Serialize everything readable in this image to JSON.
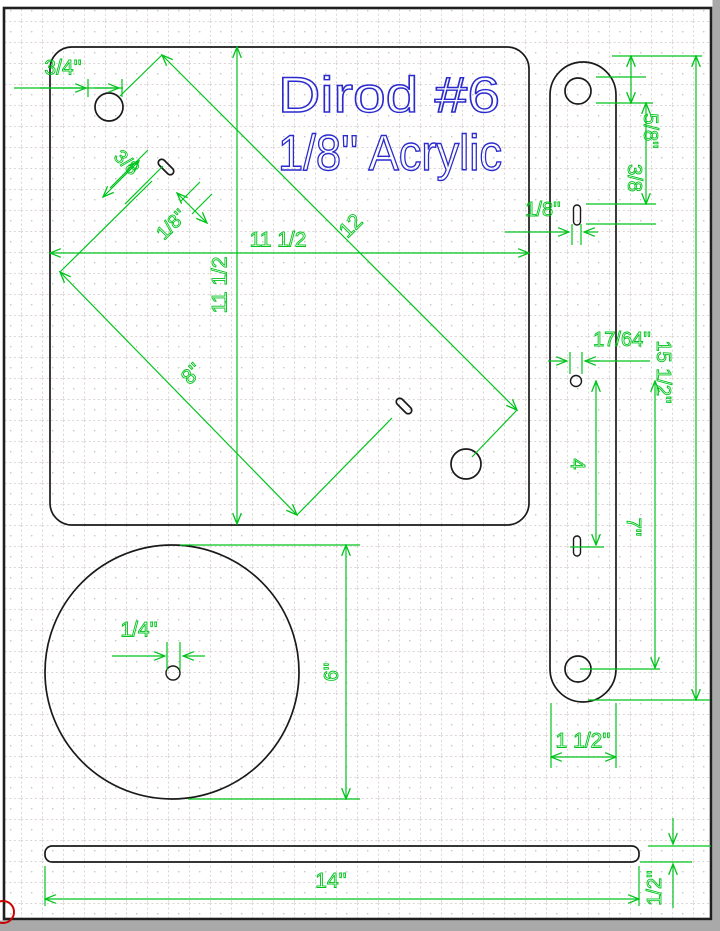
{
  "title": {
    "line1": "Dirod #6",
    "line2": "1/8'' Acrylic"
  },
  "plate": {
    "hole_offset": "3/4''",
    "width": "11 1/2",
    "height": "11 1/2",
    "hole_diagonal": "12",
    "slot_diagonal": "8''",
    "slot_length": "3/8",
    "slot_width": "1/8''"
  },
  "side_bar": {
    "end_hole_offset": "5/8''",
    "hole_to_slot": "3/8",
    "slot_width": "1/8''",
    "center_hole_dia": "17/64''",
    "length": "15 1/2''",
    "hole_to_lower_slot": "4",
    "hole_spacing": "7''",
    "width": "1 1/2''"
  },
  "disc": {
    "center_hole_dia": "1/4''",
    "diameter": "6''"
  },
  "base_strip": {
    "length": "14''",
    "thickness": "1/2''"
  },
  "colors": {
    "dimension_green": "#00c41c",
    "title_blue": "#2a2ace",
    "outline_black": "#1a1a1a",
    "stamp_red": "#cc0000",
    "grid_gray": "#d8cfcf"
  }
}
